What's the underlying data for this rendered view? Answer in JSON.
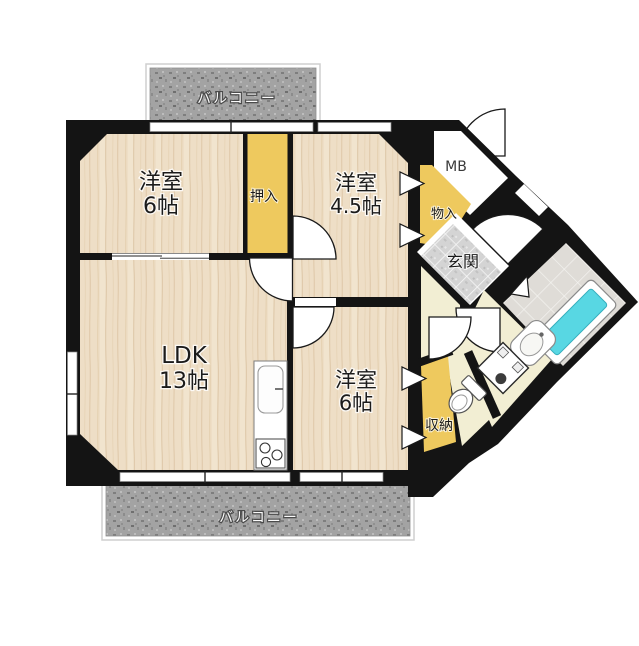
{
  "floorplan": {
    "balconies": {
      "top": {
        "label": "バルコニー"
      },
      "bottom": {
        "label": "バルコニー"
      }
    },
    "rooms": {
      "western_room_top": {
        "name": "洋室",
        "size": "6帖"
      },
      "oshiire_closet": {
        "label": "押入"
      },
      "western_room_45": {
        "name": "洋室",
        "size": "4.5帖"
      },
      "ldk": {
        "name": "LDK",
        "size": "13帖"
      },
      "western_room_bottom": {
        "name": "洋室",
        "size": "6帖"
      },
      "meter_box": {
        "label": "MB"
      },
      "monoire_closet": {
        "label": "物入"
      },
      "genkan_entrance": {
        "label": "玄関"
      },
      "shunou_closet": {
        "label": "収納"
      }
    },
    "fixtures": [
      "kitchen-sink",
      "stove",
      "bathtub",
      "washbasin",
      "washing-machine",
      "toilet"
    ],
    "colors": {
      "wall": "#141414",
      "wood_floor": "#ecdcc2",
      "closet_yellow": "#eec95e",
      "sanitary_cream": "#f2eed3",
      "entrance_tile": "#d5d5d5",
      "bath_tub": "#58d7e3",
      "balcony_gray": "#a3a3a3"
    }
  }
}
